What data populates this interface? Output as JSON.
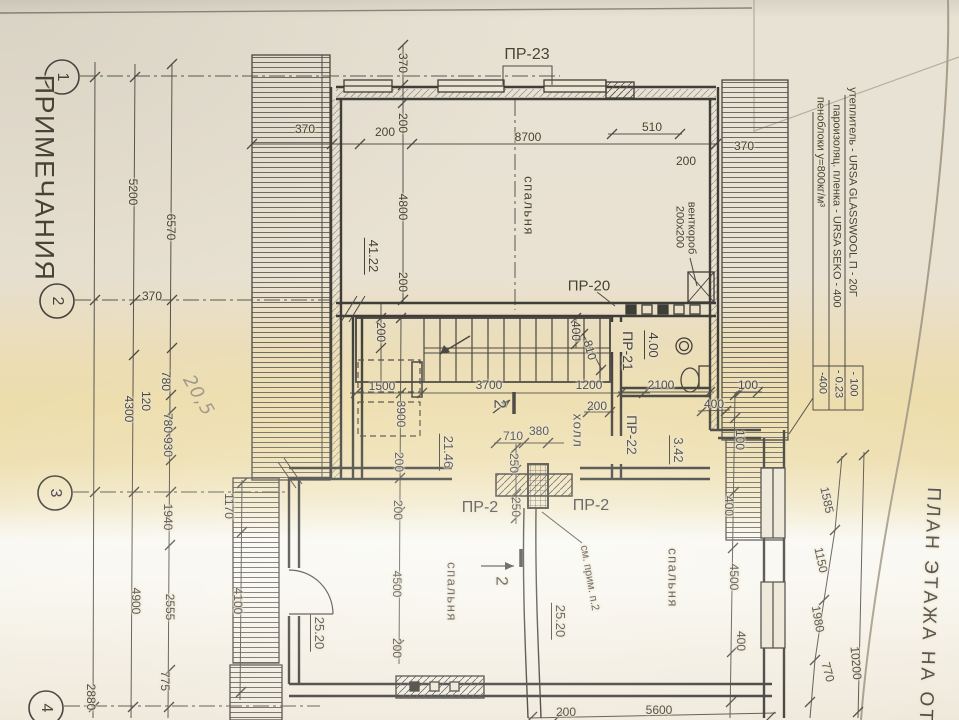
{
  "titles": [
    {
      "name": "notes-heading",
      "text": "ПРИМЕЧАНИЯ",
      "x": 44,
      "y": 178,
      "rot": 90,
      "size": 27,
      "cls": "ls1"
    },
    {
      "name": "plan-title",
      "text": "ПЛАН ЭТАЖА НА ОТМ",
      "x": 929,
      "y": 615,
      "rot": 92,
      "size": 19,
      "cls": "ls3"
    }
  ],
  "axis_bubbles": [
    {
      "name": "axis-bubble-1",
      "text": "1",
      "x": 62,
      "y": 77,
      "rot": 90,
      "size": 16
    },
    {
      "name": "axis-bubble-2",
      "text": "2",
      "x": 57,
      "y": 301,
      "rot": 90,
      "size": 16
    },
    {
      "name": "axis-bubble-3",
      "text": "3",
      "x": 55,
      "y": 493,
      "rot": 90,
      "size": 16
    },
    {
      "name": "axis-bubble-4",
      "text": "4",
      "x": 46,
      "y": 708,
      "rot": 90,
      "size": 16
    }
  ],
  "materials": [
    {
      "name": "material-note-line-1",
      "text": "утеплитель - URSA GLASSWOOL П - 20Г",
      "x": 852,
      "y": 192,
      "rot": 90,
      "size": 11
    },
    {
      "name": "material-note-value-1",
      "text": "- 100",
      "x": 853,
      "y": 384,
      "rot": 90,
      "size": 11
    },
    {
      "name": "material-note-line-2",
      "text": "пароизоляц. пленка - URSA SEKO - 400",
      "x": 836,
      "y": 206,
      "rot": 90,
      "size": 11
    },
    {
      "name": "material-note-value-2",
      "text": "- 0.23",
      "x": 838,
      "y": 384,
      "rot": 90,
      "size": 11
    },
    {
      "name": "material-note-line-3",
      "text": "пеноблоки  у=800кг/м³",
      "x": 820,
      "y": 152,
      "rot": 90,
      "size": 11
    },
    {
      "name": "material-note-value-3",
      "text": "-400",
      "x": 822,
      "y": 383,
      "rot": 90,
      "size": 11
    }
  ],
  "room_labels": [
    {
      "name": "room-bedroom-top",
      "text": "спальня",
      "x": 529,
      "y": 206,
      "rot": 90,
      "size": 13,
      "cls": "ls1"
    },
    {
      "name": "room-bedroom-left",
      "text": "спальня",
      "x": 452,
      "y": 592,
      "rot": 90,
      "size": 13,
      "cls": "ls1"
    },
    {
      "name": "room-bedroom-right",
      "text": "спальня",
      "x": 673,
      "y": 578,
      "rot": 90,
      "size": 13,
      "cls": "ls1"
    },
    {
      "name": "room-hall",
      "text": "холл",
      "x": 578,
      "y": 431,
      "rot": 90,
      "size": 13,
      "cls": "ls1"
    }
  ],
  "area_labels": [
    {
      "name": "area-bedroom-top",
      "text": "41.22",
      "x": 372,
      "y": 256,
      "rot": 90,
      "size": 13,
      "cls": "u"
    },
    {
      "name": "area-hall",
      "text": "21.46",
      "x": 447,
      "y": 452,
      "rot": 90,
      "size": 13,
      "cls": "u"
    },
    {
      "name": "area-bedroom-left",
      "text": "25.20",
      "x": 318,
      "y": 633,
      "rot": 90,
      "size": 13,
      "cls": "u"
    },
    {
      "name": "area-bedroom-right",
      "text": "25.20",
      "x": 559,
      "y": 621,
      "rot": 90,
      "size": 13,
      "cls": "u"
    },
    {
      "name": "area-bathroom",
      "text": "4.00",
      "x": 652,
      "y": 345,
      "rot": 90,
      "size": 13,
      "cls": "u"
    },
    {
      "name": "area-wc",
      "text": "3.42",
      "x": 677,
      "y": 450,
      "rot": 90,
      "size": 13,
      "cls": "u"
    }
  ],
  "product_labels": [
    {
      "name": "lintel-pr23",
      "text": "ПР-23",
      "x": 527,
      "y": 55,
      "rot": 0,
      "size": 16
    },
    {
      "name": "lintel-pr20",
      "text": "ПР-20",
      "x": 589,
      "y": 286,
      "rot": 0,
      "size": 15
    },
    {
      "name": "lintel-pr21",
      "text": "ПР-21",
      "x": 628,
      "y": 351,
      "rot": 90,
      "size": 14
    },
    {
      "name": "lintel-pr22",
      "text": "ПР-22",
      "x": 632,
      "y": 435,
      "rot": 90,
      "size": 14
    },
    {
      "name": "lintel-pr2-left",
      "text": "ПР-2",
      "x": 480,
      "y": 508,
      "rot": 0,
      "size": 16
    },
    {
      "name": "lintel-pr2-right",
      "text": "ПР-2",
      "x": 591,
      "y": 506,
      "rot": 0,
      "size": 16
    }
  ],
  "annotations": [
    {
      "name": "vent-duct-label",
      "text": "венткороб",
      "x": 691,
      "y": 228,
      "rot": 90,
      "size": 11
    },
    {
      "name": "vent-duct-size",
      "text": "200x200",
      "x": 679,
      "y": 227,
      "rot": 90,
      "size": 11
    },
    {
      "name": "see-note-ref",
      "text": "см. прим. п.2",
      "x": 589,
      "y": 578,
      "rot": 80,
      "size": 11
    },
    {
      "name": "section-mark-2-top",
      "text": "2",
      "x": 500,
      "y": 404,
      "rot": 90,
      "size": 17
    },
    {
      "name": "section-mark-2-bottom",
      "text": "2",
      "x": 502,
      "y": 581,
      "rot": 90,
      "size": 17
    },
    {
      "name": "handwritten-note",
      "text": "20,5",
      "x": 198,
      "y": 396,
      "rot": 60,
      "size": 18,
      "cls": "pencil"
    }
  ],
  "dimensions": [
    {
      "name": "dim-5200",
      "text": "5200",
      "x": 133,
      "y": 192,
      "rot": 90,
      "size": 12
    },
    {
      "name": "dim-6570",
      "text": "6570",
      "x": 171,
      "y": 227,
      "rot": 90,
      "size": 12
    },
    {
      "name": "dim-780a",
      "text": "780",
      "x": 166,
      "y": 381,
      "rot": 90,
      "size": 12
    },
    {
      "name": "dim-120",
      "text": "120",
      "x": 146,
      "y": 401,
      "rot": 90,
      "size": 12
    },
    {
      "name": "dim-4300",
      "text": "4300",
      "x": 129,
      "y": 409,
      "rot": 90,
      "size": 12
    },
    {
      "name": "dim-780b",
      "text": "780",
      "x": 168,
      "y": 423,
      "rot": 90,
      "size": 12
    },
    {
      "name": "dim-930",
      "text": "930",
      "x": 168,
      "y": 447,
      "rot": 90,
      "size": 12
    },
    {
      "name": "dim-1940",
      "text": "1940",
      "x": 168,
      "y": 517,
      "rot": 90,
      "size": 12
    },
    {
      "name": "dim-1170",
      "text": "1170",
      "x": 229,
      "y": 506,
      "rot": 90,
      "size": 12
    },
    {
      "name": "dim-4900",
      "text": "4900",
      "x": 136,
      "y": 601,
      "rot": 90,
      "size": 12
    },
    {
      "name": "dim-2555",
      "text": "2555",
      "x": 170,
      "y": 607,
      "rot": 90,
      "size": 12
    },
    {
      "name": "dim-4100",
      "text": "4100",
      "x": 238,
      "y": 601,
      "rot": 90,
      "size": 12
    },
    {
      "name": "dim-775",
      "text": "775",
      "x": 165,
      "y": 681,
      "rot": 90,
      "size": 12
    },
    {
      "name": "dim-2880",
      "text": "2880",
      "x": 91,
      "y": 697,
      "rot": 90,
      "size": 12
    },
    {
      "name": "dim-370-left-top",
      "text": "370",
      "x": 305,
      "y": 129,
      "rot": 0,
      "size": 12
    },
    {
      "name": "dim-200-top-a",
      "text": "200",
      "x": 385,
      "y": 132,
      "rot": 0,
      "size": 12
    },
    {
      "name": "dim-8700",
      "text": "8700",
      "x": 528,
      "y": 137,
      "rot": 0,
      "size": 12
    },
    {
      "name": "dim-510",
      "text": "510",
      "x": 652,
      "y": 127,
      "rot": 0,
      "size": 12
    },
    {
      "name": "dim-200-top-b",
      "text": "200",
      "x": 686,
      "y": 161,
      "rot": 0,
      "size": 12
    },
    {
      "name": "dim-370-right",
      "text": "370",
      "x": 744,
      "y": 146,
      "rot": 0,
      "size": 12
    },
    {
      "name": "dim-370-left-mid",
      "text": "370",
      "x": 152,
      "y": 296,
      "rot": 0,
      "size": 12
    },
    {
      "name": "dim-370-chain",
      "text": "370",
      "x": 403,
      "y": 63,
      "rot": 90,
      "size": 12
    },
    {
      "name": "dim-200-chain-a",
      "text": "200",
      "x": 403,
      "y": 123,
      "rot": 90,
      "size": 12
    },
    {
      "name": "dim-4800",
      "text": "4800",
      "x": 403,
      "y": 207,
      "rot": 90,
      "size": 12
    },
    {
      "name": "dim-200-chain-b",
      "text": "200",
      "x": 403,
      "y": 282,
      "rot": 90,
      "size": 12
    },
    {
      "name": "dim-200-chain-c",
      "text": "200",
      "x": 381,
      "y": 332,
      "rot": 90,
      "size": 12
    },
    {
      "name": "dim-3900",
      "text": "3900",
      "x": 401,
      "y": 414,
      "rot": 90,
      "size": 12
    },
    {
      "name": "dim-200-chain-d",
      "text": "200",
      "x": 399,
      "y": 462,
      "rot": 90,
      "size": 12
    },
    {
      "name": "dim-200-chain-e",
      "text": "200",
      "x": 398,
      "y": 510,
      "rot": 90,
      "size": 12
    },
    {
      "name": "dim-4500-left",
      "text": "4500",
      "x": 397,
      "y": 584,
      "rot": 90,
      "size": 12
    },
    {
      "name": "dim-200-chain-f",
      "text": "200",
      "x": 397,
      "y": 648,
      "rot": 90,
      "size": 12
    },
    {
      "name": "dim-1500",
      "text": "1500",
      "x": 382,
      "y": 386,
      "rot": 0,
      "size": 12
    },
    {
      "name": "dim-3700",
      "text": "3700",
      "x": 489,
      "y": 385,
      "rot": 0,
      "size": 12
    },
    {
      "name": "dim-1200",
      "text": "1200",
      "x": 589,
      "y": 385,
      "rot": 0,
      "size": 12
    },
    {
      "name": "dim-200-hall",
      "text": "200",
      "x": 597,
      "y": 406,
      "rot": 0,
      "size": 12
    },
    {
      "name": "dim-710",
      "text": "710",
      "x": 513,
      "y": 436,
      "rot": 0,
      "size": 12
    },
    {
      "name": "dim-380",
      "text": "380",
      "x": 539,
      "y": 431,
      "rot": 0,
      "size": 12
    },
    {
      "name": "dim-250a",
      "text": "250",
      "x": 514,
      "y": 463,
      "rot": 90,
      "size": 12
    },
    {
      "name": "dim-250b",
      "text": "250",
      "x": 516,
      "y": 507,
      "rot": 90,
      "size": 12
    },
    {
      "name": "dim-2100",
      "text": "2100",
      "x": 661,
      "y": 385,
      "rot": 0,
      "size": 12
    },
    {
      "name": "dim-100a",
      "text": "100",
      "x": 748,
      "y": 385,
      "rot": 0,
      "size": 12
    },
    {
      "name": "dim-400a",
      "text": "400",
      "x": 714,
      "y": 404,
      "rot": 0,
      "size": 12
    },
    {
      "name": "dim-810",
      "text": "810",
      "x": 590,
      "y": 350,
      "rot": 75,
      "size": 12
    },
    {
      "name": "dim-400b",
      "text": "400",
      "x": 576,
      "y": 331,
      "rot": 90,
      "size": 12
    },
    {
      "name": "dim-400c",
      "text": "400",
      "x": 729,
      "y": 506,
      "rot": 90,
      "size": 12
    },
    {
      "name": "dim-4500-right",
      "text": "4500",
      "x": 734,
      "y": 577,
      "rot": 90,
      "size": 12
    },
    {
      "name": "dim-400d",
      "text": "400",
      "x": 741,
      "y": 641,
      "rot": 90,
      "size": 12
    },
    {
      "name": "dim-100b",
      "text": "100",
      "x": 740,
      "y": 440,
      "rot": 90,
      "size": 12
    },
    {
      "name": "dim-1585",
      "text": "1585",
      "x": 827,
      "y": 500,
      "rot": 78,
      "size": 12
    },
    {
      "name": "dim-1150",
      "text": "1150",
      "x": 821,
      "y": 560,
      "rot": 78,
      "size": 12
    },
    {
      "name": "dim-1980",
      "text": "1980",
      "x": 818,
      "y": 619,
      "rot": 80,
      "size": 12
    },
    {
      "name": "dim-770",
      "text": "770",
      "x": 828,
      "y": 672,
      "rot": 75,
      "size": 12
    },
    {
      "name": "dim-10200",
      "text": "10200",
      "x": 856,
      "y": 663,
      "rot": 85,
      "size": 12
    },
    {
      "name": "dim-5600",
      "text": "5600",
      "x": 659,
      "y": 710,
      "rot": 0,
      "size": 12
    },
    {
      "name": "dim-200-bottom",
      "text": "200",
      "x": 566,
      "y": 712,
      "rot": 0,
      "size": 12
    }
  ]
}
